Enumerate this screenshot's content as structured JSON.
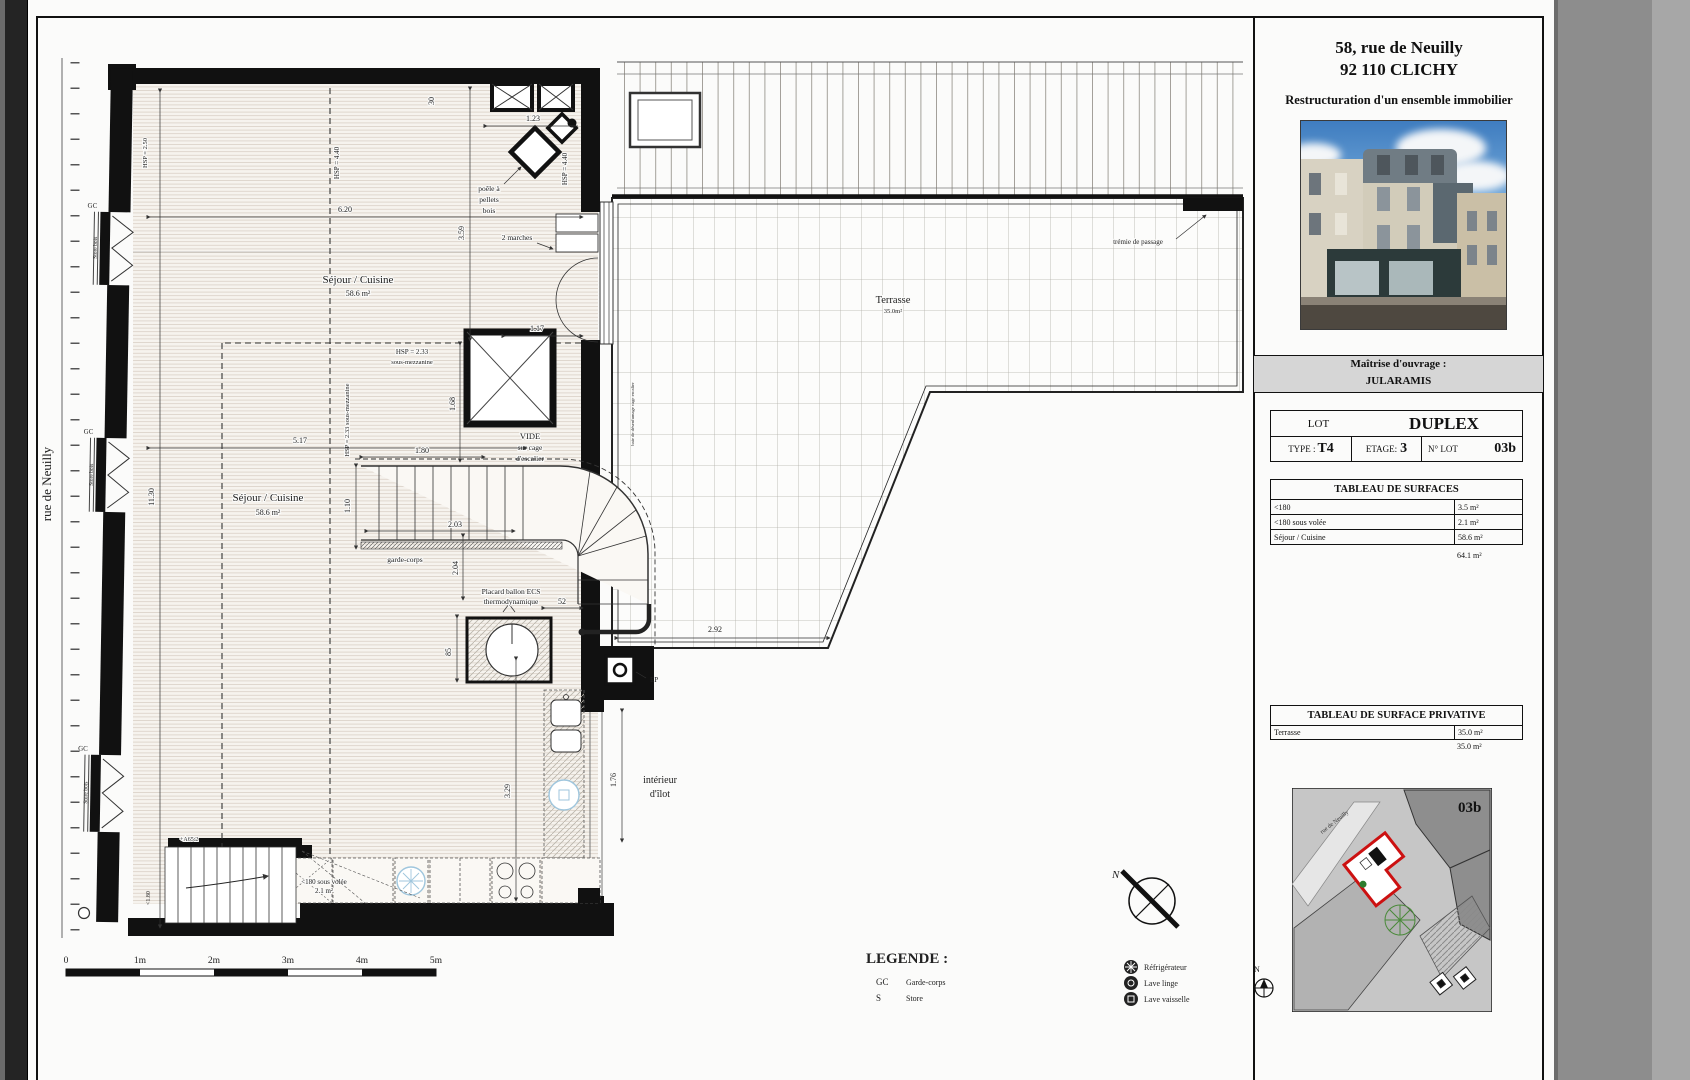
{
  "title_block": {
    "address_line1": "58, rue de Neuilly",
    "address_line2": "92 110 CLICHY",
    "subtitle": "Restructuration d'un ensemble immobilier",
    "client_label": "Maîtrise d'ouvrage :",
    "client_name": "JULARAMIS",
    "lot_table": {
      "lot_label": "LOT",
      "lot_value": "DUPLEX",
      "type_label": "TYPE :",
      "type_value": "T4",
      "etage_label": "ETAGE:",
      "etage_value": "3",
      "num_label": "N° LOT",
      "num_value": "03b"
    },
    "surfaces_table": {
      "title": "TABLEAU DE SURFACES",
      "rows": [
        {
          "label": "<180",
          "value": "3.5 m²"
        },
        {
          "label": "<180 sous volée",
          "value": "2.1 m²"
        },
        {
          "label": "Séjour / Cuisine",
          "value": "58.6 m²"
        }
      ],
      "total": "64.1 m²"
    },
    "private_table": {
      "title": "TABLEAU DE SURFACE PRIVATIVE",
      "rows": [
        {
          "label": "Terrasse",
          "value": "35.0 m²"
        }
      ],
      "total": "35.0 m²"
    },
    "site_map": {
      "lot_label": "03b",
      "street": "rue de Neuilly",
      "north": "N"
    }
  },
  "plan": {
    "labels": {
      "street": "rue de Neuilly",
      "sejour": "Séjour / Cuisine",
      "sejour_area": "58.6 m²",
      "marches": "2 marches",
      "poele1": "poêle à",
      "poele2": "pellets",
      "poele3": "bois",
      "vide1": "VIDE",
      "vide2": "sur cage",
      "vide3": "d'escalier",
      "garde_corps": "garde-corps",
      "placard1": "Placard ballon ECS",
      "placard2": "thermodynamique",
      "ilot1": "intérieur",
      "ilot2": "d'îlot",
      "terrasse": "Terrasse",
      "terrasse_area": "35.0m²",
      "tremie": "trémie de passage",
      "sous_volee": "<180 sous volée",
      "sous_volee_area": "2.1 m²",
      "hsp_mezz1": "HSP = 2.33",
      "hsp_mezz2": "sous-mezzanine",
      "hsp_mezz_rot": "HSP = 2.33 sous-mezzanine",
      "hsp440": "HSP = 4.40",
      "hsp250": "HSP = 2.50",
      "gc": "GC",
      "store": "Store bois",
      "ep": "EP",
      "baie": "baie de désenfumage cage escalier",
      "niveau": "+A65.2",
      "hsp180": "<1.80"
    },
    "dims": {
      "d620": "6.20",
      "d517": "5.17",
      "d180": "1.80",
      "d203": "2.03",
      "d110": "1.10",
      "d168": "1.68",
      "d204": "2.04",
      "d359": "3.59",
      "d30": "30",
      "d117": "1.17",
      "d123": "1.23",
      "d1130": "11.30",
      "d85": "85",
      "d52": "52",
      "d329": "3.29",
      "d292": "2.92",
      "d176": "1.76"
    }
  },
  "legend": {
    "title": "LEGENDE :",
    "abbrev": [
      {
        "code": "GC",
        "label": "Garde-corps"
      },
      {
        "code": "S",
        "label": "Store"
      }
    ],
    "appliances": [
      {
        "label": "Réfrigérateur"
      },
      {
        "label": "Lave linge"
      },
      {
        "label": "Lave vaisselle"
      }
    ]
  },
  "scale_bar": {
    "labels": [
      "0",
      "1m",
      "2m",
      "3m",
      "4m",
      "5m"
    ]
  },
  "compass": {
    "north": "N"
  },
  "colors": {
    "accent_red": "#cc1111",
    "appliance_blue": "#9fc6dd",
    "paper": "#fbfbfa",
    "band_gray": "#d6d6d6"
  }
}
